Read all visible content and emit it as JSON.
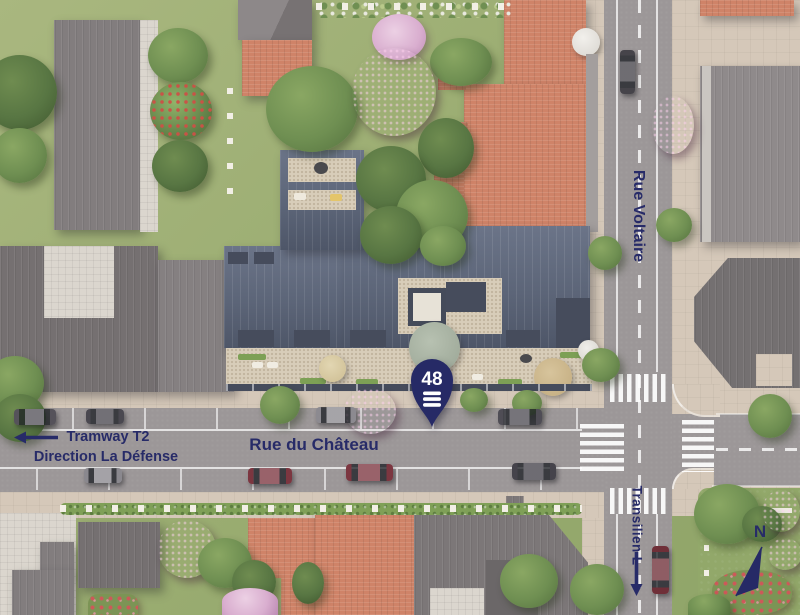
{
  "scene": {
    "description": "Aerial site plan of a residence at 48 Rue du Château with surrounding streets and transit directions",
    "streets": {
      "horizontal": "Rue du Château",
      "vertical": "Rue Voltaire"
    },
    "transit": {
      "tram_line": "Tramway T2",
      "tram_direction": "Direction La Défense",
      "rail_line": "Transilien L"
    },
    "marker": {
      "number": "48",
      "logo": "three-bars"
    },
    "compass": {
      "north": "N"
    },
    "icons": {
      "tram_arrow": "arrow-left",
      "rail_arrow": "arrow-down",
      "marker_icon": "map-pin",
      "compass_icon": "north-needle"
    },
    "colors": {
      "accent_navy": "#272b68",
      "road": "#9c9798",
      "sidewalk": "#d5c8b9",
      "lawn": "#9dae73",
      "terracotta_roof": "#cf8368",
      "gray_roof": "#7e797a",
      "slate_roof": "#5d6578",
      "magenta_tree": "#a24a8b",
      "marker_text": "#ffffff"
    }
  }
}
